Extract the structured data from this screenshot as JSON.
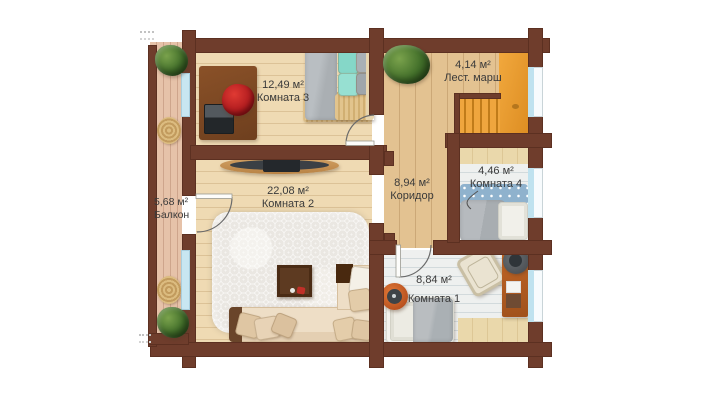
{
  "rooms": [
    {
      "area": "12,49 м²",
      "name": "Комната 3"
    },
    {
      "area": "4,14 м²",
      "name": "Лест. марш"
    },
    {
      "area": "8,94 м²",
      "name": "Коридор"
    },
    {
      "area": "4,46 м²",
      "name": "Комната 4"
    },
    {
      "area": "22,08 м²",
      "name": "Комната 2"
    },
    {
      "area": "8,84 м²",
      "name": "Комната 1"
    },
    {
      "area": "5,68 м²",
      "name": "Балкон"
    }
  ],
  "colors": {
    "wall": "#6f3d2c",
    "stairs": "#eda43c",
    "window_glass": "#bfe2ef",
    "floor_warm": "#efdab3",
    "floor_corridor": "#e3c291",
    "floor_light": "#eef0ef",
    "floor_balcony": "#e6c2a9",
    "chair_red": "#c0272d",
    "pillow_teal": "#85d7c8"
  }
}
